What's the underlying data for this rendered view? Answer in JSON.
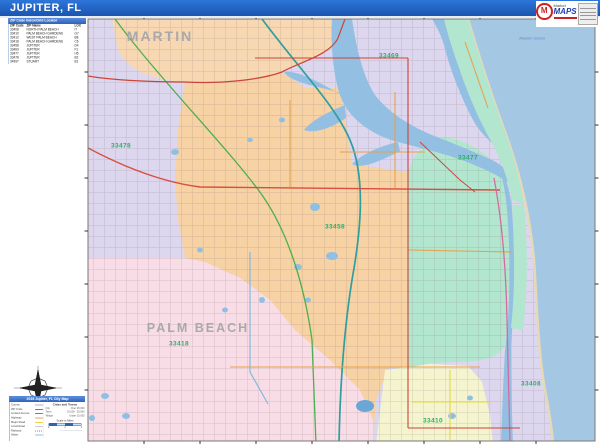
{
  "page": {
    "title": "JUPITER, FL"
  },
  "logo": {
    "name": "MarketMAPS",
    "monogram": "M",
    "text_market": "Market",
    "text_maps": "MAPS"
  },
  "zip_table": {
    "title": "ZIP Code Index/Grid Locator",
    "columns": [
      "ZIP Code",
      "ZIP Name",
      "LOC"
    ],
    "rows": [
      [
        "33408",
        "NORTH PALM BEACH",
        "I7"
      ],
      [
        "33410",
        "PALM BEACH GARDENS",
        "G7"
      ],
      [
        "33412",
        "WEST PALM BEACH",
        "B8"
      ],
      [
        "33418",
        "PALM BEACH GARDENS",
        "C6"
      ],
      [
        "33458",
        "JUPITER",
        "D4"
      ],
      [
        "33469",
        "JUPITER",
        "F1"
      ],
      [
        "33477",
        "JUPITER",
        "H5"
      ],
      [
        "33478",
        "JUPITER",
        "B2"
      ],
      [
        "34997",
        "STUART",
        "B1"
      ]
    ]
  },
  "map": {
    "county_labels": [
      {
        "text": "MARTIN"
      },
      {
        "text": "PALM BEACH"
      }
    ],
    "zip_labels": [
      {
        "text": "33478"
      },
      {
        "text": "33469"
      },
      {
        "text": "33477"
      },
      {
        "text": "33458"
      },
      {
        "text": "33418"
      },
      {
        "text": "33408"
      },
      {
        "text": "33410"
      }
    ],
    "ocean_label": "Atlantic Ocean",
    "colors": {
      "title_bar": "#1d63c8",
      "zip_label_green": "#2fae67",
      "county_label_gray": "#a9a9a9",
      "region_martin_peach": "#f7d8b2",
      "region_jupiter_orange": "#f6d2a4",
      "region_pink": "#f8dde6",
      "region_yellow": "#f4f4cf",
      "region_teal": "#b2e6cf",
      "region_lavender": "#dcd7ee",
      "ocean_blue": "#a4c7e4",
      "water_blue": "#93bfe2",
      "boundary_red": "#cc4438",
      "turnpike_green": "#4caf50",
      "interstate_teal": "#2e9e9e",
      "highway_orange": "#e8a14c",
      "us1_magenta": "#d66a9e"
    }
  },
  "legend": {
    "title": "2016 Jupiter, FL City Map",
    "items": [
      {
        "label": "County",
        "color": "#b0a8c0"
      },
      {
        "label": "ZIP Code",
        "color": "#d94f3f"
      },
      {
        "label": "Limited Access",
        "color": "#2e9e9e"
      },
      {
        "label": "Highway",
        "color": "#e8a14c"
      },
      {
        "label": "Major Road",
        "color": "#e8d44c"
      },
      {
        "label": "Local Road",
        "color": "#cccccc"
      },
      {
        "label": "Railroad",
        "color": "#888888"
      },
      {
        "label": "Water",
        "color": "#93bfe2"
      }
    ],
    "cities_title": "Cities and Towns",
    "city_rows": [
      {
        "left": "City",
        "right": "Over 25,000"
      },
      {
        "left": "Town",
        "right": "10,000 - 25,000"
      },
      {
        "left": "Village",
        "right": "Under 10,000"
      }
    ],
    "scale_label": "Scale in Miles",
    "scale_ticks": [
      "0",
      "1",
      "2"
    ]
  }
}
